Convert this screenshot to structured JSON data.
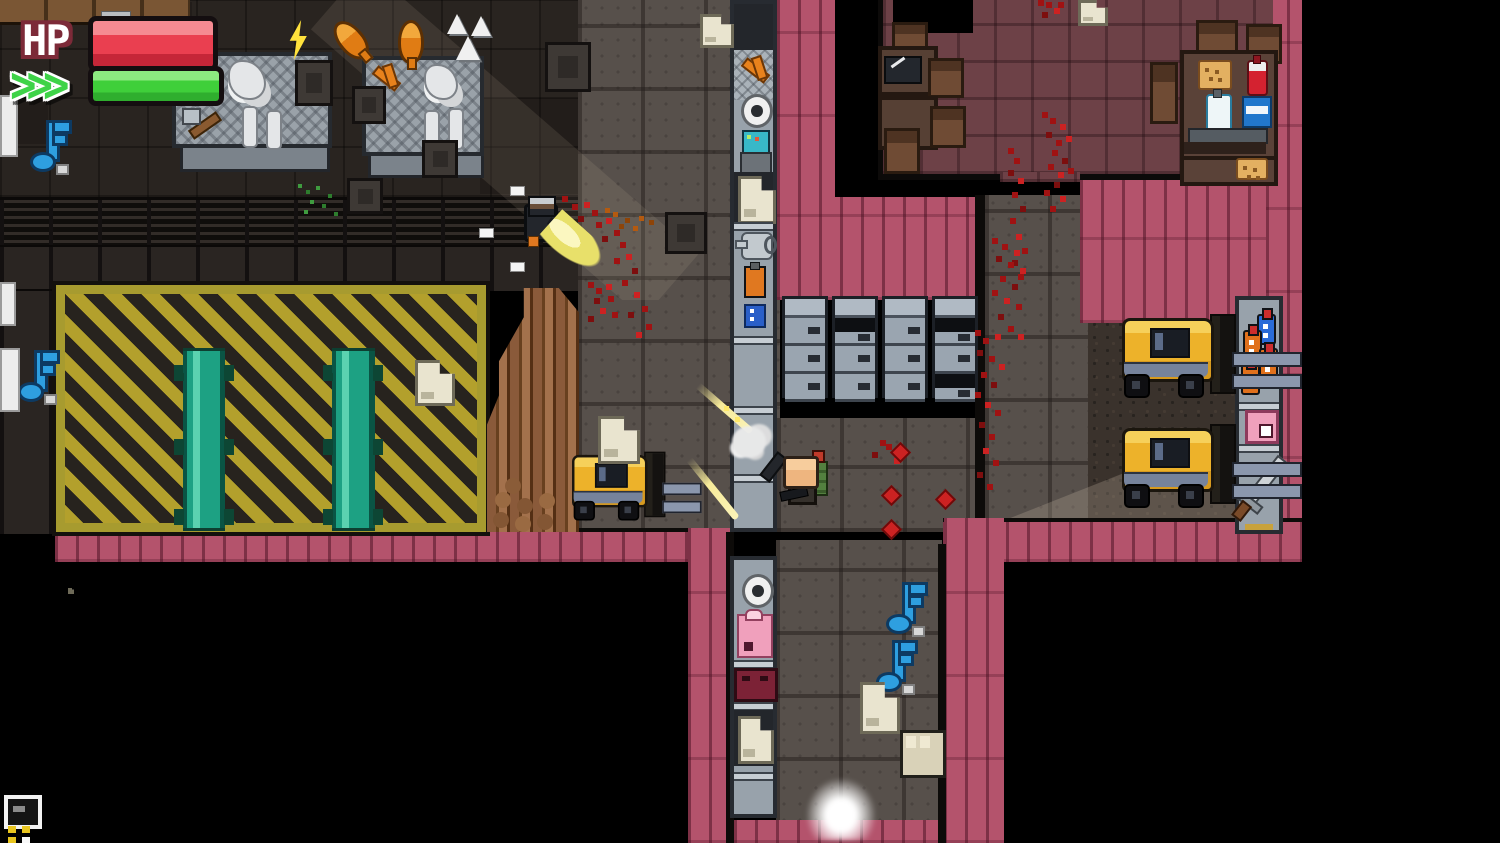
{
  "meta": {
    "description": "Top-down pixel-art action roguelike gameplay screenshot: factory / cafeteria level with player firing at an enemy"
  },
  "hud": {
    "hp_label": "HP",
    "hp_percent": 100,
    "stamina_chevrons": ">>>",
    "stamina_percent": 100
  },
  "colors": {
    "hp-fill": "#ea3f50",
    "hp-fill-light": "#f58a92",
    "hp-outline": "#7c2a38",
    "stamina-fill": "#3fcf3a",
    "stamina-fill-light": "#8cea80",
    "bar-border": "#140e10",
    "chevron-green": "#3ed348",
    "planks": "#b4536c",
    "hazard-yellow": "#b3a02c",
    "hazard-dark": "#27231e",
    "hazard-border": "#a79b2f",
    "conveyor-teal": "#1da183",
    "factory-floor": "#292420",
    "stone-floor": "#57504b",
    "cafeteria-floor": "#6d4147",
    "forklift-floor": "#3a322c",
    "locker-body": "#99a3ad",
    "locker-frame": "#1c2026",
    "forklift-yellow": "#edb22a",
    "blood": "#a01212",
    "blood-bright": "#cc2222",
    "note-blue": "#2e9fe0",
    "paper": "#e9e4cf",
    "tracer-yellow": "#f7eb9a",
    "flash-yellow": "#e8e06a"
  },
  "scene_objects": {
    "characters": [
      {
        "name": "player",
        "action": "firing pistol, green backpack"
      },
      {
        "name": "enemy",
        "action": "firing with muzzle flash, bleeding"
      }
    ],
    "vehicles": {
      "forklifts": 3
    },
    "furniture": {
      "workbenches": 2,
      "locker_cabinets": 4,
      "cafeteria_tables": 4,
      "chairs": 9,
      "conveyor_belts": 2,
      "shelf_racks": 3,
      "log_pile": 1
    },
    "pickups": {
      "music_notes": 4,
      "paper_scraps": 8,
      "crates": 3,
      "bottles": 4,
      "food_items": 4
    },
    "effects": [
      "muzzle-flash",
      "bullet-tracer",
      "smoke-puff",
      "blood-splatter",
      "light-glow",
      "light-shaft"
    ]
  }
}
